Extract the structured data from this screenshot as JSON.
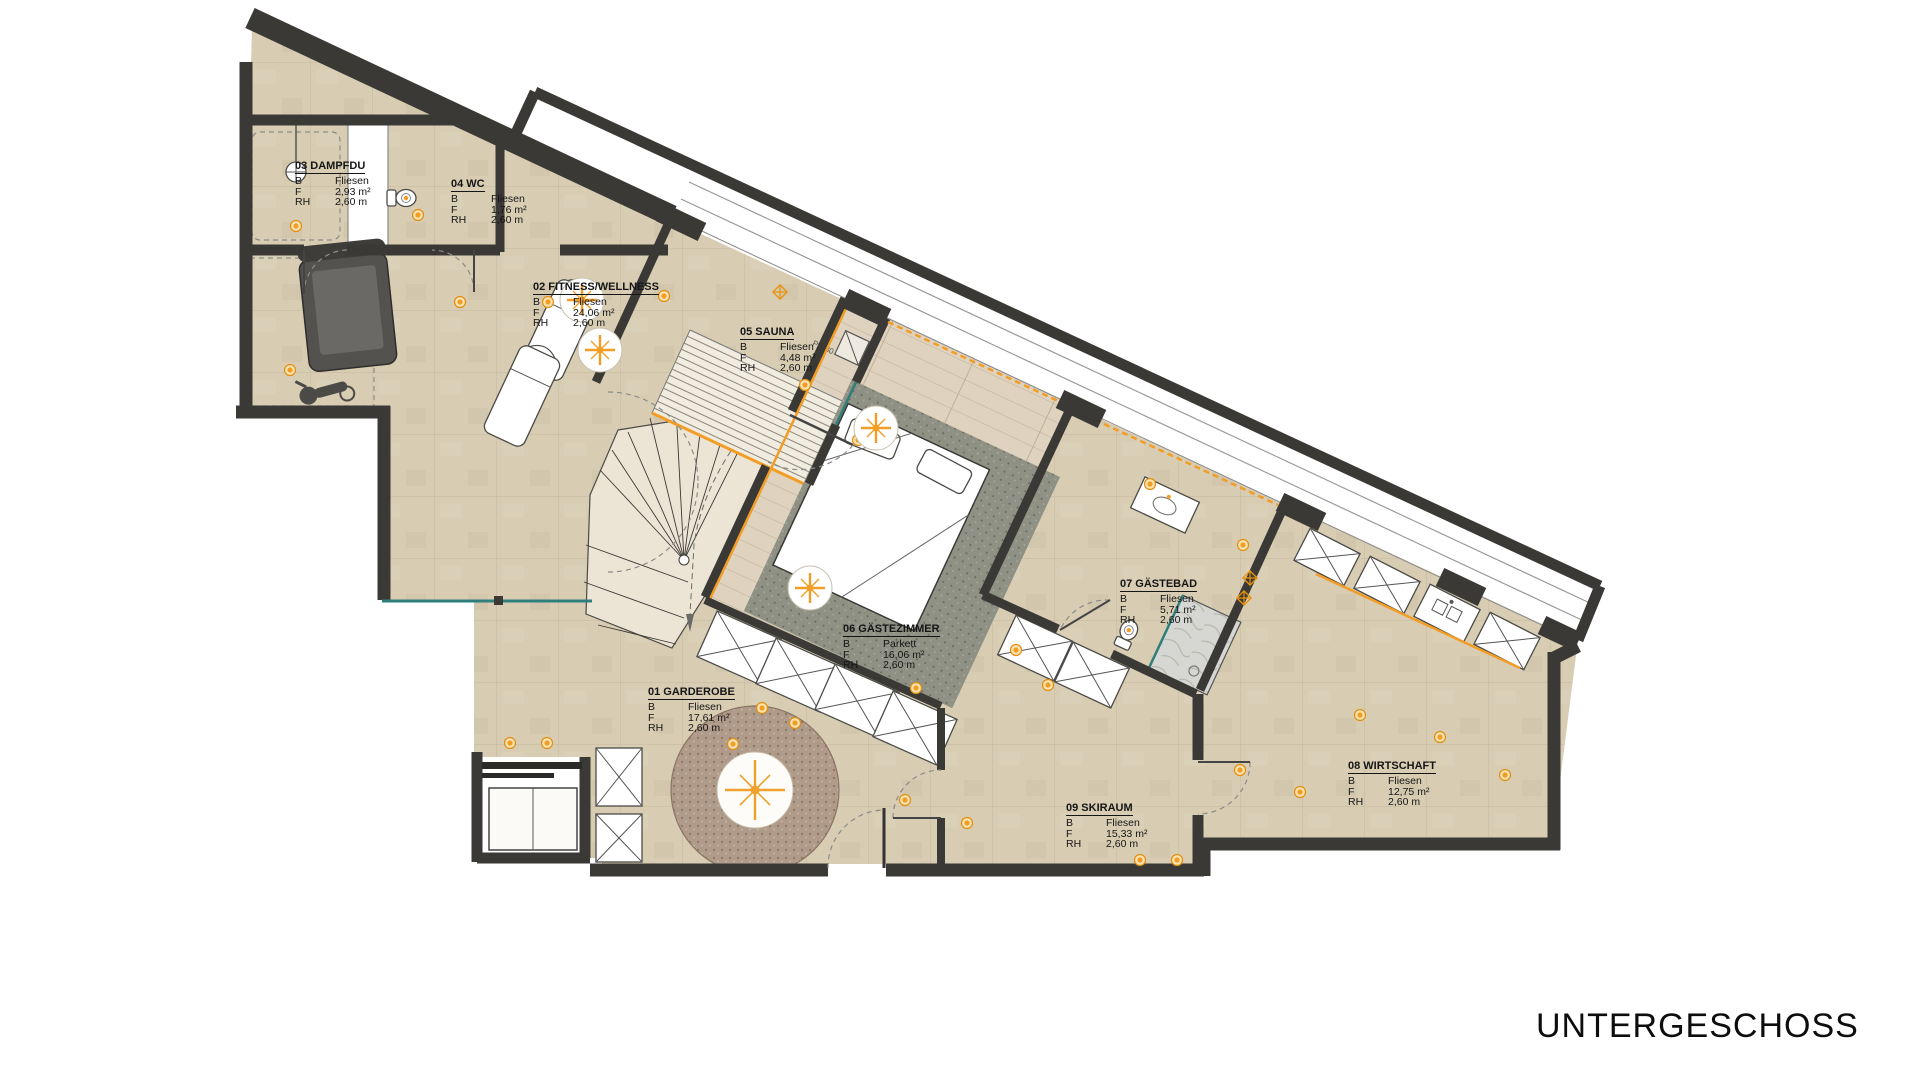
{
  "title_text": "UNTERGESCHOSS",
  "legend": {
    "b": "B",
    "f": "F",
    "rh": "RH"
  },
  "rooms": [
    {
      "label": "01 GARDEROBE",
      "b": "Fliesen",
      "f": "17,61 m²",
      "rh": "2,60 m"
    },
    {
      "label": "02 FITNESS/WELLNESS",
      "b": "Fliesen",
      "f": "24,06 m²",
      "rh": "2,60 m"
    },
    {
      "label": "03 DAMPFDU",
      "b": "Fliesen",
      "f": "2,93 m²",
      "rh": "2,60 m"
    },
    {
      "label": "04 WC",
      "b": "Fliesen",
      "f": "1,76 m²",
      "rh": "2,60 m"
    },
    {
      "label": "05 SAUNA",
      "b": "Fliesen",
      "f": "4,48 m²",
      "rh": "2,60 m"
    },
    {
      "label": "06 GÄSTEZIMMER",
      "b": "Parkett",
      "f": "16,06 m²",
      "rh": "2,60 m"
    },
    {
      "label": "07 GÄSTEBAD",
      "b": "Fliesen",
      "f": "5,71 m²",
      "rh": "2,60 m"
    },
    {
      "label": "08 WIRTSCHAFT",
      "b": "Fliesen",
      "f": "12,75 m²",
      "rh": "2,60 m"
    },
    {
      "label": "09 SKIRAUM",
      "b": "Fliesen",
      "f": "15,33 m²",
      "rh": "2,60 m"
    }
  ],
  "annotations": {
    "sauna_pipe": "PH 80"
  },
  "colors": {
    "wall": "#3a3936",
    "floor_tile": "#d8cdb3",
    "parquet": "#dfd3bf",
    "bed_rug": "#8e9183",
    "round_rug": "#b09b8a",
    "stairs": "#ece4d4",
    "accent_orange": "#f29d25",
    "glass_teal": "#2e7e7b"
  },
  "lights": [
    [
      296,
      226
    ],
    [
      418,
      215
    ],
    [
      460,
      302
    ],
    [
      548,
      302
    ],
    [
      290,
      370
    ],
    [
      664,
      296
    ],
    [
      805,
      385
    ],
    [
      858,
      440
    ],
    [
      916,
      688
    ],
    [
      1016,
      650
    ],
    [
      1048,
      685
    ],
    [
      762,
      708
    ],
    [
      795,
      723
    ],
    [
      733,
      744
    ],
    [
      510,
      743
    ],
    [
      547,
      743
    ],
    [
      905,
      800
    ],
    [
      967,
      823
    ],
    [
      1140,
      860
    ],
    [
      1177,
      860
    ],
    [
      1240,
      770
    ],
    [
      1300,
      792
    ],
    [
      1360,
      715
    ],
    [
      1440,
      737
    ],
    [
      1505,
      775
    ],
    [
      1150,
      484
    ],
    [
      1243,
      545
    ]
  ],
  "compass_lights": [
    [
      582,
      300
    ],
    [
      600,
      350
    ],
    [
      876,
      428
    ],
    [
      810,
      588
    ]
  ],
  "detectors": [
    [
      780,
      292
    ],
    [
      1250,
      578
    ],
    [
      1244,
      598
    ]
  ]
}
